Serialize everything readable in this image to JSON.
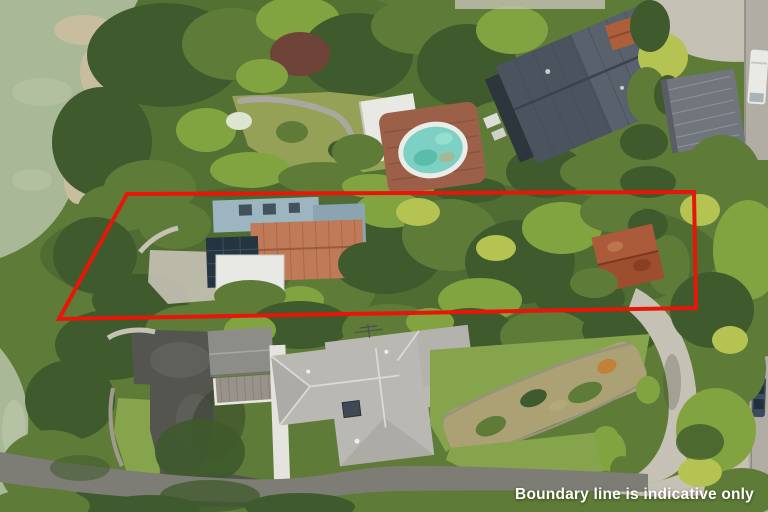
{
  "image": {
    "kind": "aerial-photograph",
    "subject": "Waterfront residential properties seen from above with a red property-boundary outline",
    "width": 768,
    "height": 512
  },
  "overlay": {
    "caption": "Boundary line is indicative only"
  },
  "boundary": {
    "color": "#e81508",
    "stroke_width": 4,
    "points": [
      [
        127,
        194
      ],
      [
        694,
        192
      ],
      [
        696,
        308
      ],
      [
        59,
        319
      ]
    ]
  },
  "colors": {
    "water": "#a9b897",
    "shore": "#c9bda0",
    "veg_dark": "#3f5a2c",
    "veg_mid": "#5e7c38",
    "veg_bright": "#82a440",
    "veg_yellow": "#b4c352",
    "lawn": "#86a44c",
    "lawn_olive": "#95a156",
    "pool_water": "#7cd0c4",
    "pool_rim": "#e9ece7",
    "pool_deck": "#9c6049",
    "roof_dark": "#4b545e",
    "roof_shingle": "#71757c",
    "roof_blue": "#9db4c1",
    "roof_terracotta": "#bf7a57",
    "roof_white": "#e8e9e4",
    "roof_light": "#bab8b2",
    "shed_rust": "#9c4e2f",
    "asphalt": "#55554f",
    "road": "#7d7d76",
    "road_light": "#b1ada4",
    "concrete": "#c6c1b5",
    "boundary": "#e81508",
    "caption": "#ffffff"
  }
}
